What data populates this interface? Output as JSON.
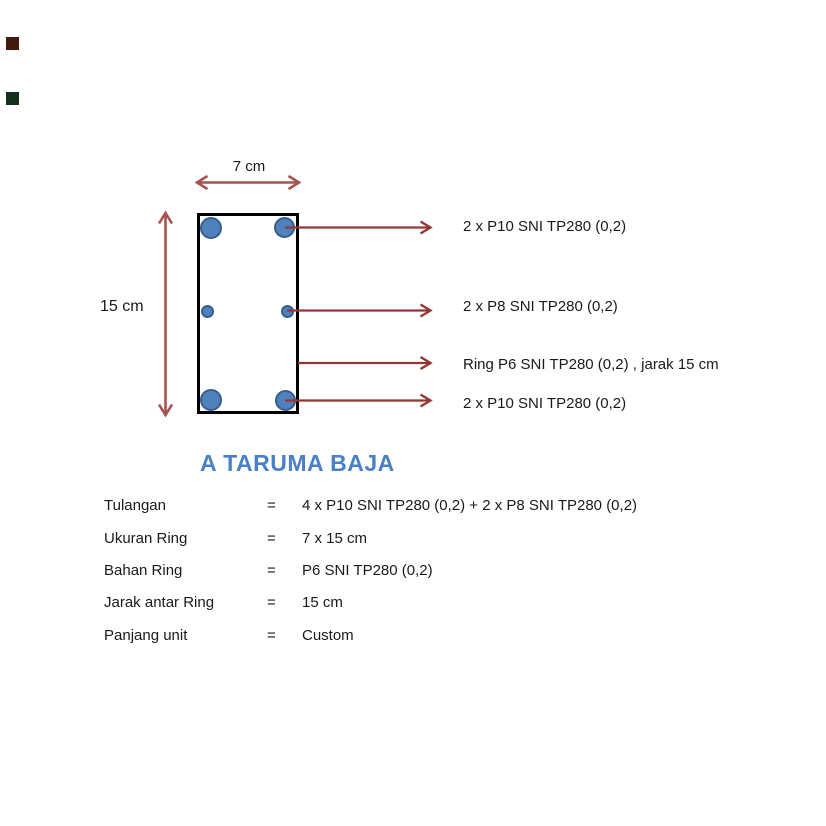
{
  "colors": {
    "arrow_red": "#943634",
    "dim_red": "#a9534f",
    "rebar_fill": "#4f81bd",
    "rebar_stroke": "#385d8a",
    "rect_border": "#000000",
    "title_blue": "#4a80c8",
    "text_black": "#1a1a1a",
    "corner_top": "#44190f",
    "corner_bottom": "#17301d"
  },
  "diagram": {
    "width_label": "7 cm",
    "height_label": "15 cm",
    "callouts": [
      {
        "text": "2 x P10 SNI TP280 (0,2)"
      },
      {
        "text": "2 x P8 SNI TP280 (0,2)"
      },
      {
        "text": "Ring P6 SNI TP280 (0,2) , jarak 15 cm"
      },
      {
        "text": "2 x P10 SNI TP280 (0,2)"
      }
    ]
  },
  "title": {
    "text": "A TARUMA BAJA"
  },
  "specs": {
    "rows": [
      {
        "label": "Tulangan",
        "eq": "=",
        "value": "4 x P10 SNI TP280 (0,2) + 2 x P8 SNI TP280 (0,2)"
      },
      {
        "label": "Ukuran Ring",
        "eq": "=",
        "value": "7 x 15 cm"
      },
      {
        "label": "Bahan Ring",
        "eq": "=",
        "value": "P6 SNI TP280 (0,2)"
      },
      {
        "label": "Jarak antar Ring",
        "eq": "=",
        "value": "15 cm"
      },
      {
        "label": "Panjang unit",
        "eq": "=",
        "value": "Custom"
      }
    ]
  }
}
